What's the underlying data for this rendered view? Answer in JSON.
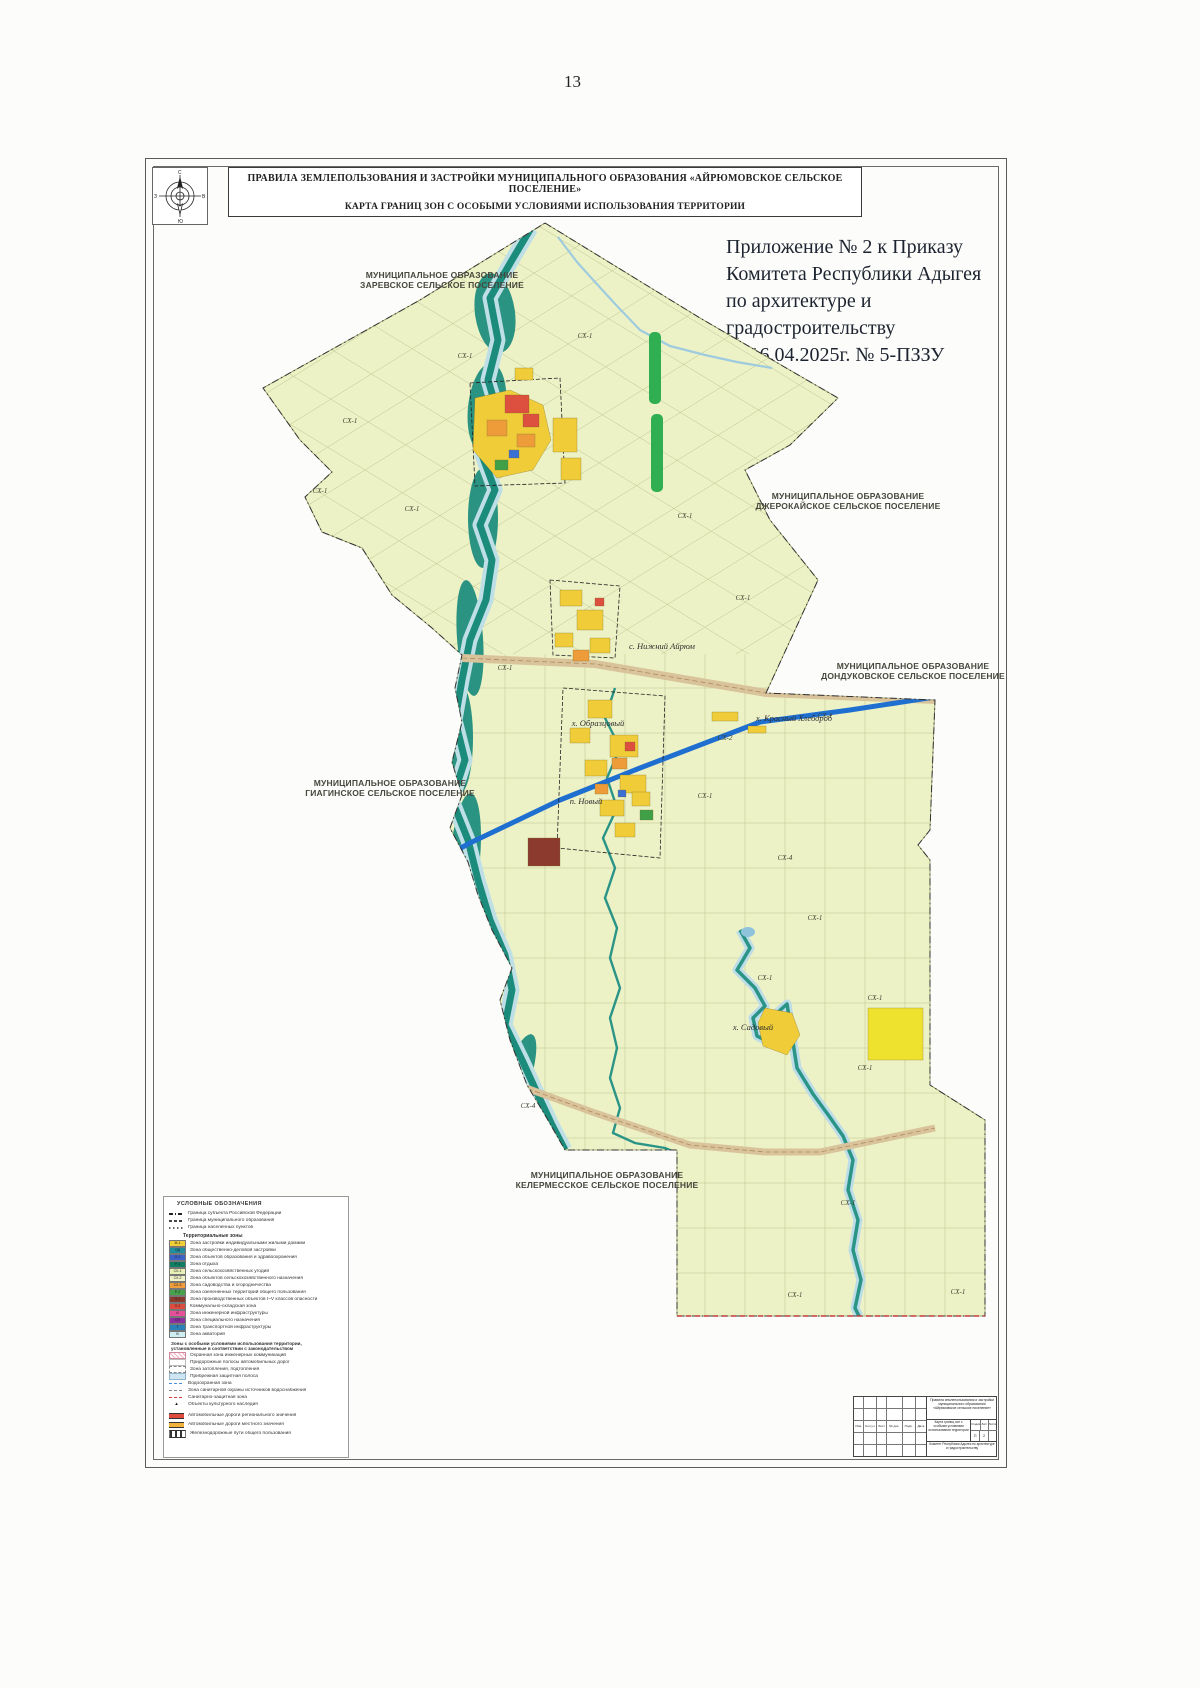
{
  "page": {
    "number": "13"
  },
  "title_block": {
    "line1": "ПРАВИЛА ЗЕМЛЕПОЛЬЗОВАНИЯ И ЗАСТРОЙКИ МУНИЦИПАЛЬНОГО ОБРАЗОВАНИЯ «АЙРЮМОВСКОЕ СЕЛЬСКОЕ ПОСЕЛЕНИЕ»",
    "line2": "КАРТА ГРАНИЦ ЗОН С ОСОБЫМИ УСЛОВИЯМИ ИСПОЛЬЗОВАНИЯ ТЕРРИТОРИИ"
  },
  "annex": {
    "lines": [
      "Приложение № 2 к Приказу",
      "Комитета Республики Адыгея",
      "по архитектуре и градостроительству",
      "от 16.04.2025г. № 5-ПЗЗУ"
    ]
  },
  "compass": {
    "n": "С",
    "s": "Ю",
    "e": "В",
    "w": "З"
  },
  "neighbors": [
    {
      "line1": "МУНИЦИПАЛЬНОЕ ОБРАЗОВАНИЕ",
      "line2": "ЗАРЕВСКОЕ СЕЛЬСКОЕ ПОСЕЛЕНИЕ"
    },
    {
      "line1": "МУНИЦИПАЛЬНОЕ ОБРАЗОВАНИЕ",
      "line2": "ДЖЕРОКАЙСКОЕ СЕЛЬСКОЕ ПОСЕЛЕНИЕ"
    },
    {
      "line1": "МУНИЦИПАЛЬНОЕ ОБРАЗОВАНИЕ",
      "line2": "ДОНДУКОВСКОЕ СЕЛЬСКОЕ ПОСЕЛЕНИЕ"
    },
    {
      "line1": "МУНИЦИПАЛЬНОЕ ОБРАЗОВАНИЕ",
      "line2": "ГИАГИНСКОЕ СЕЛЬСКОЕ ПОСЕЛЕНИЕ"
    },
    {
      "line1": "МУНИЦИПАЛЬНОЕ ОБРАЗОВАНИЕ",
      "line2": "КЕЛЕРМЕССКОЕ СЕЛЬСКОЕ ПОСЕЛЕНИЕ"
    }
  ],
  "map": {
    "settlements": [
      {
        "text": "с. Нижний Айрюм",
        "x": 497,
        "y": 431
      },
      {
        "text": "х. Красный Хлебороб",
        "x": 629,
        "y": 503
      },
      {
        "text": "х. Образцовый",
        "x": 433,
        "y": 508
      },
      {
        "text": "п. Новый",
        "x": 421,
        "y": 586
      },
      {
        "text": "х. Садовый",
        "x": 588,
        "y": 812
      }
    ],
    "zone_codes": [
      {
        "text": "СХ-1",
        "x": 155,
        "y": 275
      },
      {
        "text": "СХ-1",
        "x": 247,
        "y": 293
      },
      {
        "text": "СХ-1",
        "x": 185,
        "y": 205
      },
      {
        "text": "СХ-1",
        "x": 300,
        "y": 140
      },
      {
        "text": "СХ-1",
        "x": 420,
        "y": 120
      },
      {
        "text": "СХ-1",
        "x": 520,
        "y": 300
      },
      {
        "text": "СХ-1",
        "x": 578,
        "y": 382
      },
      {
        "text": "СХ-1",
        "x": 340,
        "y": 452
      },
      {
        "text": "СХ-2",
        "x": 560,
        "y": 522
      },
      {
        "text": "СХ-1",
        "x": 660,
        "y": 500
      },
      {
        "text": "СХ-1",
        "x": 540,
        "y": 580
      },
      {
        "text": "СХ-4",
        "x": 620,
        "y": 642
      },
      {
        "text": "СХ-1",
        "x": 650,
        "y": 702
      },
      {
        "text": "СХ-1",
        "x": 600,
        "y": 762
      },
      {
        "text": "СХ-1",
        "x": 710,
        "y": 782
      },
      {
        "text": "СХ-4",
        "x": 363,
        "y": 890
      },
      {
        "text": "СХ-1",
        "x": 683,
        "y": 987
      },
      {
        "text": "СХ-1",
        "x": 700,
        "y": 852
      },
      {
        "text": "СХ-1",
        "x": 630,
        "y": 1079
      },
      {
        "text": "СХ-1",
        "x": 793,
        "y": 1076
      }
    ]
  },
  "legend": {
    "title": "УСЛОВНЫЕ ОБОЗНАЧЕНИЯ",
    "boundaries": [
      {
        "type": "b1",
        "label": "Граница субъекта Российской Федерации"
      },
      {
        "type": "b2",
        "label": "Граница муниципального образования"
      },
      {
        "type": "b3",
        "label": "Граница населенных пунктов"
      }
    ],
    "zones_header": "Территориальные зоны",
    "zones": [
      {
        "code": "Ж-1",
        "color": "#f2cf35",
        "label": "Зона застройки индивидуальными жилыми домами"
      },
      {
        "code": "ОД",
        "color": "#1f8f9f",
        "label": "Зона общественно-деловой застройки"
      },
      {
        "code": "О-1",
        "color": "#3c64c8",
        "label": "Зона объектов образования и здравоохранения"
      },
      {
        "code": "Р-1",
        "color": "#0f7f63",
        "label": "Зона отдыха"
      },
      {
        "code": "СХ-1",
        "color": "#e7f0b5",
        "label": "Зона сельскохозяйственных угодий"
      },
      {
        "code": "СХ-2",
        "color": "#eef2c6",
        "label": "Зона объектов сельскохозяйственного назначения"
      },
      {
        "code": "СХ-3",
        "color": "#ef9e3b",
        "label": "Зона садоводства и огородничества"
      },
      {
        "code": "Р-2",
        "color": "#46a34c",
        "label": "Зона озелененных территорий общего пользования"
      },
      {
        "code": "П-1",
        "color": "#8c3a2d",
        "label": "Зона производственных объектов I–V классов опасности"
      },
      {
        "code": "П-2",
        "color": "#e04b3f",
        "label": "Коммунально-складская зона"
      },
      {
        "code": "И",
        "color": "#e64f9a",
        "label": "Зона инженерной инфраструктуры"
      },
      {
        "code": "СН",
        "color": "#8c2fa0",
        "label": "Зона специального назначения"
      },
      {
        "code": "Т",
        "color": "#2b80b8",
        "label": "Зона транспортной инфраструктуры"
      },
      {
        "code": "В",
        "color": "#cfeef2",
        "label": "Зона акваторий"
      }
    ],
    "special_header_1": "Зоны с особыми условиями использования территории,",
    "special_header_2": "установленные в соответствии с законодательством",
    "special": [
      {
        "type": "hatch-pink",
        "label": "Охранная зона инженерных коммуникаций"
      },
      {
        "type": "blank",
        "label": "Придорожные полосы автомобильных дорог"
      },
      {
        "type": "outline",
        "label": "Зона затопления, подтопления"
      },
      {
        "type": "fill-blue",
        "label": "Прибрежная защитная полоса"
      },
      {
        "type": "dash-blue",
        "label": "Водоохранная зона"
      },
      {
        "type": "dash-gray",
        "label": "Зона санитарной охраны источников водоснабжения"
      },
      {
        "type": "dash-red",
        "label": "Санитарно-защитная зона"
      },
      {
        "type": "monument",
        "icon": "▴",
        "label": "Объекты культурного наследия"
      }
    ],
    "linear": [
      {
        "type": "road-red",
        "label": "Автомобильные дороги регионального значения"
      },
      {
        "type": "road-orange",
        "label": "Автомобильные дороги местного значения"
      },
      {
        "type": "road-hatch",
        "label": "Железнодорожные пути общего пользования"
      }
    ]
  },
  "stamp": {
    "header_cells": [
      "Изм.",
      "Кол.уч.",
      "Лист",
      "№ док.",
      "Подп.",
      "Дата"
    ],
    "doc_title": "Правила землепользования и застройки муниципального образования «Айрюмовское сельское поселение»",
    "sheet_title": "Карта границ зон с особыми условиями использования территории",
    "stage_label": "Стадия",
    "sheet_label": "Лист",
    "sheets_label": "Листов",
    "stage": "П",
    "sheet_no": "2",
    "sheets_total": "",
    "org": "Комитет Республики Адыгея по архитектуре и градостроительству"
  }
}
